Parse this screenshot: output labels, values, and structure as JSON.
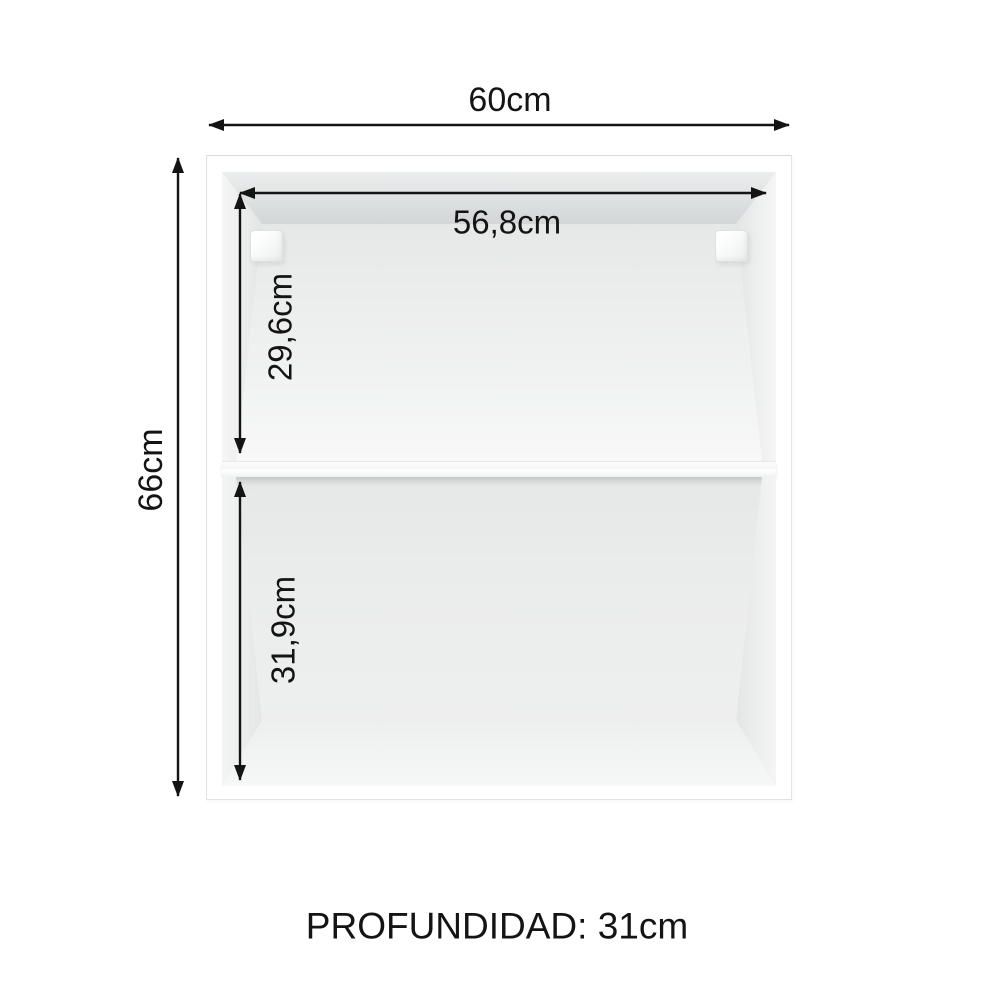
{
  "labels": {
    "width": "60cm",
    "height": "66cm",
    "inner_width": "56,8cm",
    "upper_compartment_height": "29,6cm",
    "lower_compartment_height": "31,9cm",
    "depth": "PROFUNDIDAD: 31cm"
  },
  "colors": {
    "annotation": "#141414",
    "cabinet_frame": "#ffffff",
    "outline": "#e2e4e4",
    "interior_shade": "#d4d7d7",
    "interior_light": "#f6f7f7"
  }
}
